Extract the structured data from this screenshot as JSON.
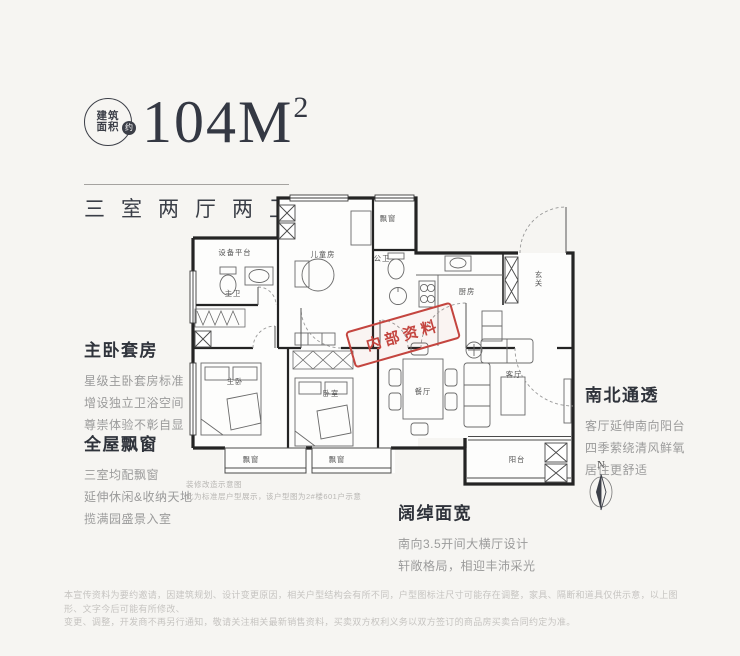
{
  "colors": {
    "background": "#f6f5f2",
    "ink": "#343843",
    "stamp_red": "#c4453f",
    "wall": "#242424"
  },
  "header": {
    "badge_line1": "建筑",
    "badge_line2": "面积",
    "badge_approx": "约",
    "area": "104M",
    "area_sup": "2",
    "subtitle": "三室两厅两卫"
  },
  "floorplan": {
    "stamp": "内部资料",
    "compass_label": "N",
    "rooms": {
      "equipment": "设备平台",
      "master_bath": "主卫",
      "kids_room": "儿童房",
      "bay_top": "飘窗",
      "public_bath": "公卫",
      "kitchen": "厨房",
      "foyer": "玄关",
      "master_bedroom": "主卧",
      "bedroom2": "卧室",
      "dining": "餐厅",
      "living": "客厅",
      "bay_left": "飘窗",
      "bay_mid": "飘窗",
      "balcony": "阳台"
    },
    "note_line1": "装修改造示意图",
    "note_line2": "此为标准层户型展示，该户型图为2#楼601户示意"
  },
  "features": [
    {
      "title": "主卧套房",
      "lines": [
        "星级主卧套房标准",
        "增设独立卫浴空间",
        "尊崇体验不彰自显"
      ]
    },
    {
      "title": "全屋飘窗",
      "lines": [
        "三室均配飘窗",
        "延伸休闲&收纳天地",
        "揽满园盛景入室"
      ]
    },
    {
      "title": "南北通透",
      "lines": [
        "客厅延伸南向阳台",
        "四季萦绕清风鲜氧",
        "居住更舒适"
      ]
    },
    {
      "title": "阔绰面宽",
      "lines": [
        "南向3.5开间大横厅设计",
        "轩敞格局，相迎丰沛采光"
      ]
    }
  ],
  "disclaimer": {
    "line1": "本宣传资料为要约邀请，因建筑规划、设计变更原因，相关户型结构会有所不同，户型图标注尺寸可能存在调整，家具、隔断和道具仅供示意，以上图形、文字今后可能有所修改、",
    "line2": "变更、调整，开发商不再另行通知，敬请关注相关最新销售资料，买卖双方权利义务以双方签订的商品房买卖合同约定为准。"
  }
}
